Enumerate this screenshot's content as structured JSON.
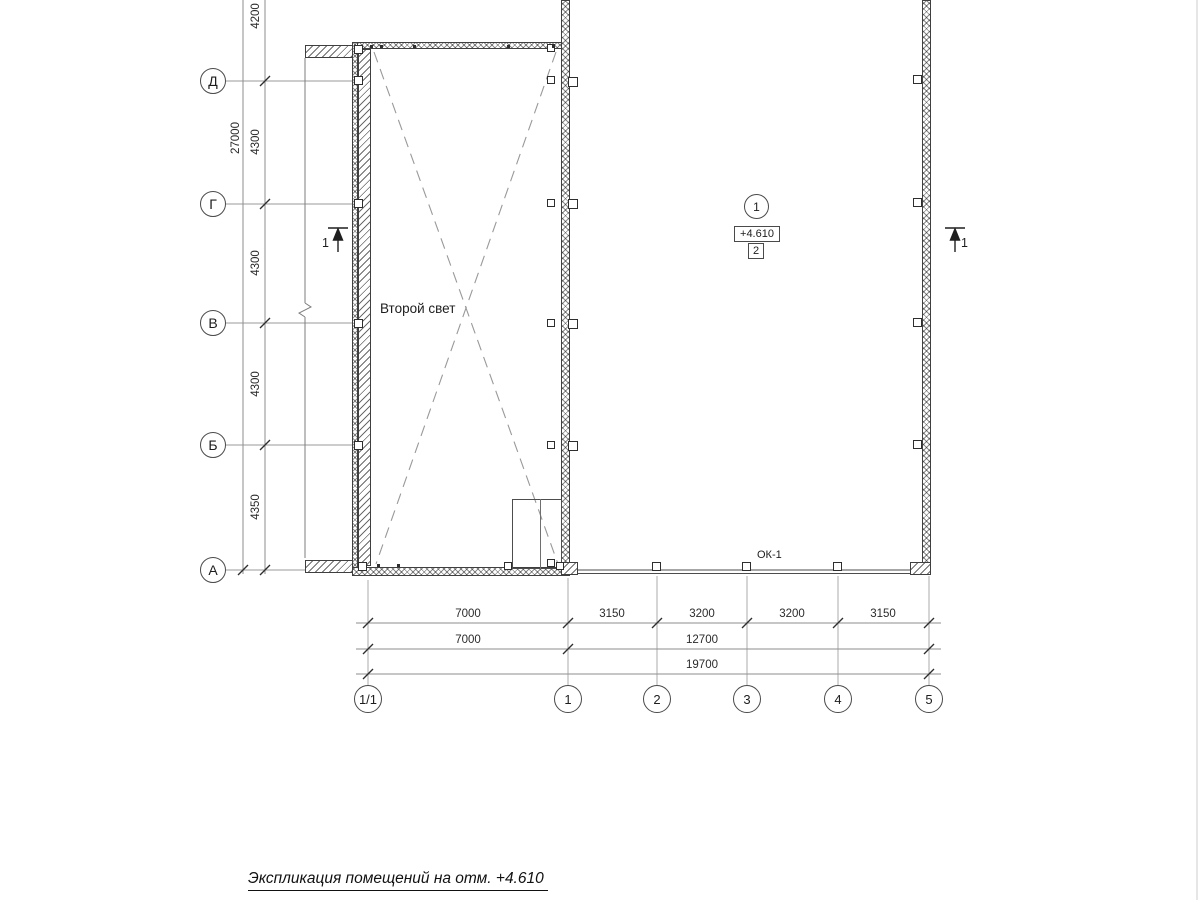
{
  "plan": {
    "title": "Экспликация помещений на отм. +4.610",
    "void_label": "Второй свет",
    "window_label": "ОК-1",
    "room_marker": {
      "number": "1",
      "elevation": "+4.610",
      "code": "2"
    },
    "section_marks": {
      "left": "1",
      "right": "1"
    },
    "axes": {
      "rows": [
        {
          "label": "Д"
        },
        {
          "label": "Г"
        },
        {
          "label": "В"
        },
        {
          "label": "Б"
        },
        {
          "label": "А"
        }
      ],
      "cols": [
        {
          "label": "1/1"
        },
        {
          "label": "1"
        },
        {
          "label": "2"
        },
        {
          "label": "3"
        },
        {
          "label": "4"
        },
        {
          "label": "5"
        }
      ]
    },
    "dims": {
      "left_overall": "27000",
      "left_segments": [
        "4200",
        "4300",
        "4300",
        "4300",
        "4350"
      ],
      "bottom_row1": [
        "7000",
        "3150",
        "3200",
        "3200",
        "3150"
      ],
      "bottom_row2": [
        "7000",
        "12700"
      ],
      "bottom_overall": "19700"
    },
    "colors": {
      "wall_line": "#3f3f3f",
      "axis_line": "#999999",
      "text": "#222222"
    }
  }
}
